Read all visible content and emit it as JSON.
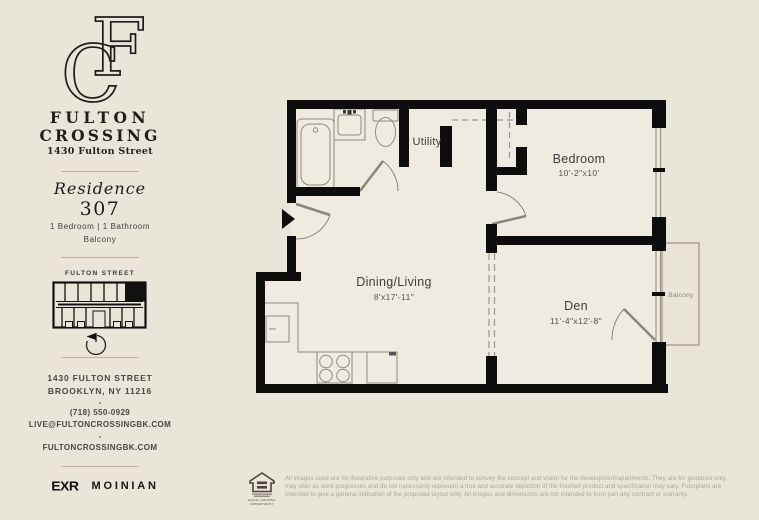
{
  "colors": {
    "background": "#e9e5d9",
    "plan_fill": "#efebe0",
    "wall": "#0d0d0d",
    "accent_line": "#bdb298",
    "fixture_line": "#8f8a7d",
    "muted_text": "#aaa59a"
  },
  "sidebar": {
    "brand": {
      "monogram_c": "C",
      "monogram_f": "F",
      "name_line1": "FULTON",
      "name_line2": "CROSSING",
      "address_script": "1430 Fulton Street"
    },
    "residence": {
      "label": "Residence",
      "number": "307",
      "features": "1 Bedroom  |  1 Bathroom",
      "feature_extra": "Balcony"
    },
    "keyplan": {
      "street_label": "FULTON STREET"
    },
    "contact": {
      "address_line1": "1430 FULTON STREET",
      "address_line2": "BROOKLYN, NY 11216",
      "separator": "-",
      "phone": "(718) 550-0929",
      "email": "LIVE@FULTONCROSSINGBK.COM",
      "website": "FULTONCROSSINGBK.COM"
    },
    "logos": {
      "exr": "EXR",
      "moinian": "MOINIAN"
    }
  },
  "floorplan": {
    "rooms": [
      {
        "name": "Utility",
        "dims": ""
      },
      {
        "name": "Bedroom",
        "dims": "10'-2\"x10'"
      },
      {
        "name": "Dining/Living",
        "dims": "8'x17'-11\""
      },
      {
        "name": "Den",
        "dims": "11'-4\"x12'-8\""
      },
      {
        "name": "Balcony",
        "dims": ""
      }
    ]
  },
  "footer": {
    "equal_housing": "EQUAL HOUSING OPPORTUNITY",
    "disclaimer_lines": [
      "All images used are for illustrative purposes only and are intended to convey the concept and vision for the development/apartments. They are for guidance only,",
      "may alter as work progresses and do not necessarily represent a true and accurate depiction of the finished product and specification may vary. Floorplans are",
      "intended to give a general indication of the proposed layout only. All images and dimensions are not intended to form part any contract or warranty."
    ]
  }
}
